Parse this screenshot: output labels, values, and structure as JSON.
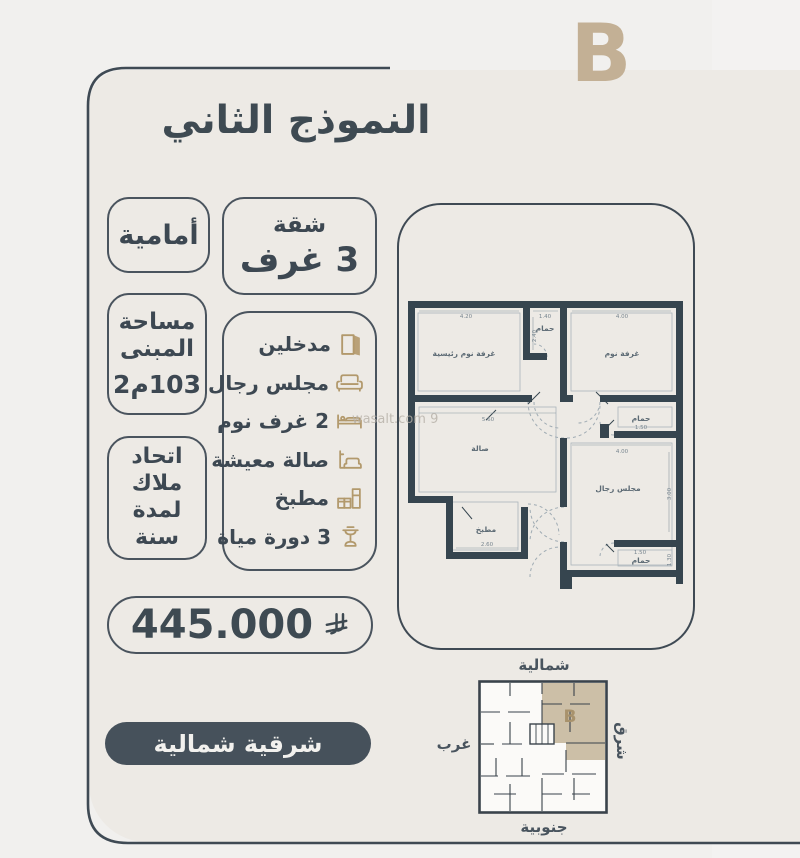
{
  "page": {
    "letter_badge": "B",
    "title": "النموذج الثاني",
    "watermark": "wasalt.com 9"
  },
  "badges": {
    "front": "أمامية",
    "apartment": {
      "line1": "شقة",
      "line2": "3 غرف"
    },
    "area": {
      "line1": "مساحة",
      "line2": "المبنى",
      "value": "103م2"
    },
    "hoa": {
      "line1": "اتحاد",
      "line2": "ملاك",
      "line3": "لمدة",
      "line4": "سنة"
    },
    "price": "445.000",
    "orientation": "شرقية شمالية"
  },
  "features": [
    {
      "label": "مدخلين",
      "icon": "door-icon"
    },
    {
      "label": "مجلس رجال",
      "icon": "sofa-icon"
    },
    {
      "label": "2 غرف نوم",
      "icon": "bed-icon"
    },
    {
      "label": "صالة معيشة",
      "icon": "couch-icon"
    },
    {
      "label": "مطبخ",
      "icon": "kitchen-icon"
    },
    {
      "label": "3 دورة مياة",
      "icon": "basin-icon"
    }
  ],
  "floorplan": {
    "rooms": {
      "master": "غرفة نوم رئيسية",
      "bath_top": "حمام",
      "bedroom": "غرفة نوم",
      "hall": "صالة",
      "bath_right": "حمام",
      "majlis": "مجلس رجال",
      "kitchen": "مطبخ",
      "bath_bottom": "حمام"
    },
    "dims": {
      "master_top": "4.20",
      "bath_top": "1.40",
      "bedroom_top": "4.00",
      "bath_side": "2.40",
      "hall_top": "5.60",
      "bath_right": "1.50",
      "majlis_top": "4.00",
      "majlis_side": "3.00",
      "kitchen_bottom": "2.60",
      "bath_bottom": "1.50",
      "bath_bottom_side": "1.30"
    }
  },
  "miniplan": {
    "north": "شمالية",
    "south": "جنوبية",
    "west": "غرب",
    "east": "شرق",
    "unit_label": "B"
  },
  "colors": {
    "slate": "#3e4a54",
    "tan_letter": "#c3b095",
    "icon_gold": "#b2996c",
    "pill_bg": "#46515b",
    "wall": "#36454f",
    "unit_fill": "#ccbfa7"
  }
}
